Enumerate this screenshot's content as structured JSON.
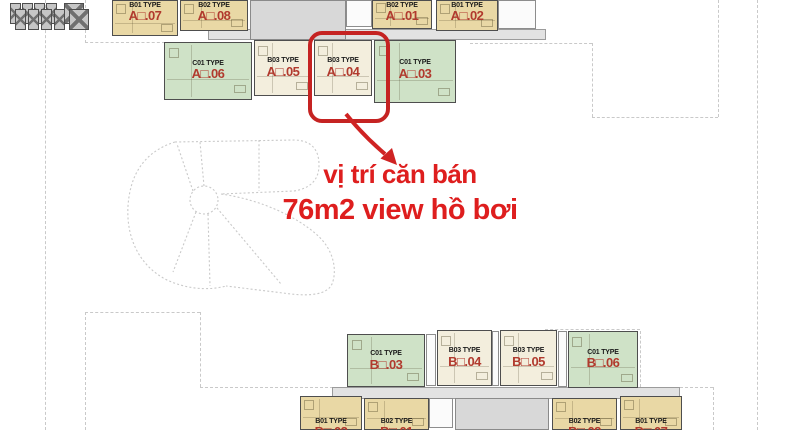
{
  "annotation": {
    "line1": "vị trí căn bán",
    "line2": "76m2 view hồ bơi",
    "color": "#de1e1e"
  },
  "highlighted_unit": "B03 TYPE B□.04 (A□.04)",
  "colors": {
    "unit_tan": "#e9d8a5",
    "unit_cream": "#f3eedd",
    "unit_green": "#cfe2c7",
    "core_gray": "#d8d8d8",
    "highlight_red": "#c52322",
    "annotation_red": "#de1e1e",
    "unit_number_red": "#b13a2e"
  },
  "buildings": {
    "top": {
      "lift_lobby": "LIFT LOBBY",
      "units": [
        {
          "type": "B01 TYPE",
          "code": "A□.07"
        },
        {
          "type": "B02 TYPE",
          "code": "A□.08"
        },
        {
          "type": "B02 TYPE",
          "code": "A□.01"
        },
        {
          "type": "B01 TYPE",
          "code": "A□.02"
        },
        {
          "type": "C01 TYPE",
          "code": "A□.06"
        },
        {
          "type": "B03 TYPE",
          "code": "A□.05"
        },
        {
          "type": "B03 TYPE",
          "code": "A□.04"
        },
        {
          "type": "C01 TYPE",
          "code": "A□.03"
        }
      ]
    },
    "bottom": {
      "lift_lobby": "LIFT LOBBY",
      "units": [
        {
          "type": "C01 TYPE",
          "code": "B□.03"
        },
        {
          "type": "B03 TYPE",
          "code": "B□.04"
        },
        {
          "type": "B03 TYPE",
          "code": "B□.05"
        },
        {
          "type": "C01 TYPE",
          "code": "B□.06"
        },
        {
          "type": "B01 TYPE",
          "code": "B□.02"
        },
        {
          "type": "B02 TYPE",
          "code": "B□.01"
        },
        {
          "type": "B02 TYPE",
          "code": "B□.08"
        },
        {
          "type": "B01 TYPE",
          "code": "B□.07"
        }
      ]
    }
  }
}
